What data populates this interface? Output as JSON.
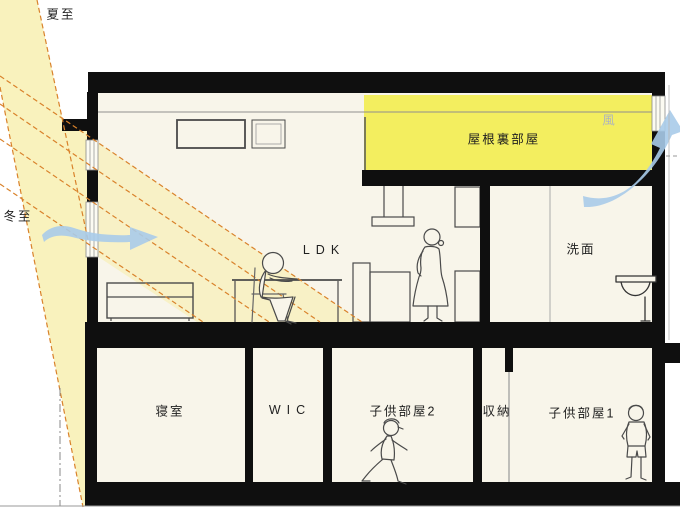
{
  "rooms": {
    "attic": "屋根裏部屋",
    "ldk": "LDK",
    "washroom": "洗面",
    "bedroom": "寝室",
    "wic": "WIC",
    "kids_room_2": "子供部屋2",
    "storage": "収納",
    "kids_room_1": "子供部屋1"
  },
  "annotations": {
    "summer_solstice": "夏至",
    "winter_solstice": "冬至",
    "wind": "風"
  },
  "colors": {
    "sunlight_beam": "#f8efad",
    "attic_highlight": "#f3ee5f",
    "sun_ray_dash": "#d9822b",
    "wind_arrow": "#a9cbe9",
    "structure_black": "#0f0f0f",
    "interior_fill": "#f8f5ea"
  }
}
